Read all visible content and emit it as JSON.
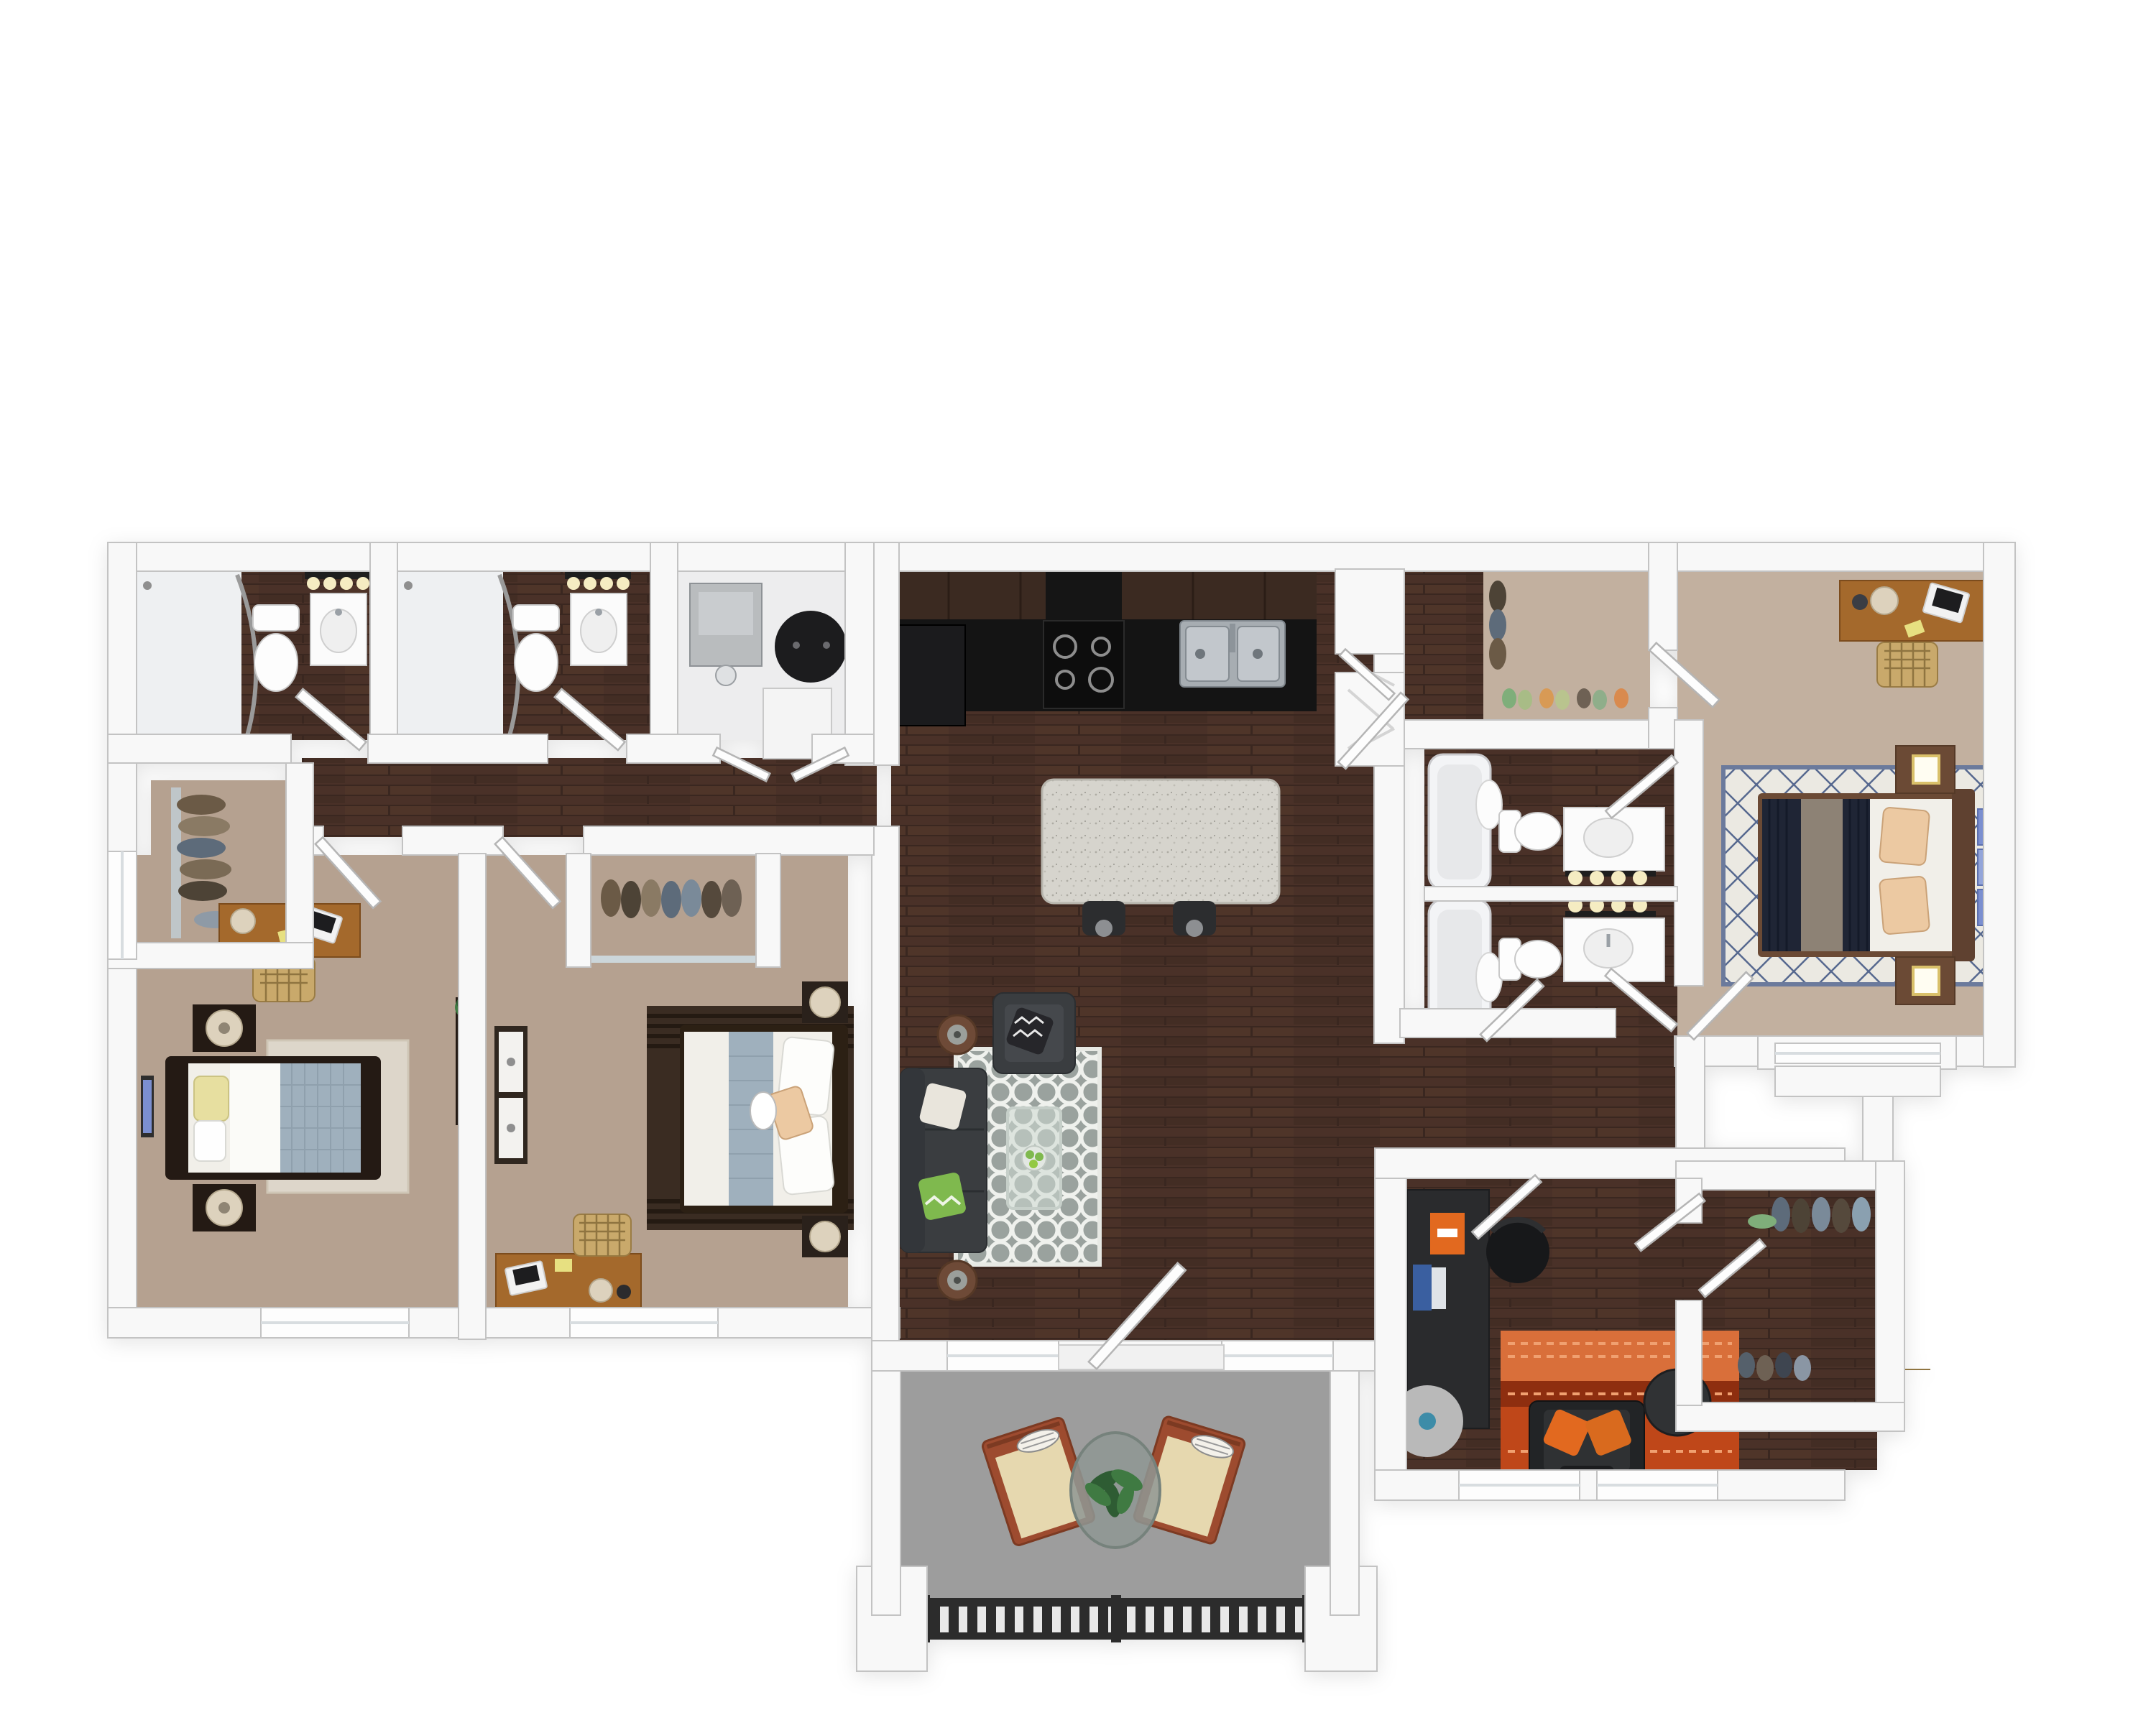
{
  "colors": {
    "wall": "#f8f8f8",
    "wall-stroke": "#c3c3c3",
    "wood": "#4a3128",
    "wood-dark": "#3a2720",
    "wood-light": "#593b2c",
    "carpet": "#b5a190",
    "carpet-light": "#c2b09f",
    "tile": "#eef0f2",
    "white-floor": "#ededee",
    "counter": "#141414",
    "cabinet": "#3b2a21",
    "steel": "#a7adb2",
    "island": "#d6d4cd",
    "stool": "#2c2d2f",
    "sofa": "#3a3d40",
    "pillow-white": "#e9e5dc",
    "pillow-green": "#7fb94e",
    "pillow-bw": "#26262a",
    "rug-gray": "#9aa29e",
    "rug-white": "#eff1ed",
    "glass": "#cdd8d2",
    "desk-wood": "#a4692c",
    "chair-tan": "#c9a96b",
    "bed-white": "#f1efe9",
    "duvet-gray": "#9fb0bd",
    "pillow-yellow": "#e7dfa0",
    "dark-furn": "#241a14",
    "lamp-cream": "#ddd2bd",
    "navy": "#1f2535",
    "throw-gray": "#8d8275",
    "pillow-peach": "#ecc9a2",
    "ns-wood": "#6b4a35",
    "lamp-gold": "#d9c06a",
    "art-blue": "#7b8fd0",
    "rug-diamond-bg": "#ebe9e2",
    "rug-diamond-line": "#56688f",
    "office-desk": "#2a2b2d",
    "accent-orange": "#e2691f",
    "rug-orange": "#bf4719",
    "rug-orange-dark": "#8e2e0f",
    "rug-orange-light": "#d96f3a",
    "patio": "#9d9d9d",
    "railing": "#2c2c2c",
    "chair-frame": "#9d4b2f",
    "cushion": "#e6d8af",
    "plant": "#2e5c33",
    "plant-light": "#3f7a42",
    "bulb": "#f5ecc2",
    "fixture": "#1e1e1e",
    "tub": "#f3f4f6",
    "appliance-gray": "#b9bcbe",
    "heater": "#1c1c1e"
  },
  "plan": {
    "view": "top-down-3d-floor-plan",
    "rooms": [
      {
        "name": "bathroom-1",
        "furniture": [
          "walk-in-shower",
          "curtain-rod",
          "toilet",
          "vanity-sink",
          "vanity-lights",
          "door"
        ]
      },
      {
        "name": "bathroom-2",
        "furniture": [
          "walk-in-shower",
          "curtain-rod",
          "toilet",
          "vanity-sink",
          "vanity-lights",
          "door"
        ]
      },
      {
        "name": "laundry-room",
        "furniture": [
          "washer",
          "water-heater",
          "dryer",
          "bifold-doors"
        ]
      },
      {
        "name": "kitchen",
        "furniture": [
          "upper-cabinets",
          "black-countertop",
          "refrigerator",
          "range",
          "range-hood",
          "double-sink",
          "pantry",
          "corner-shelves",
          "island",
          "bar-stools"
        ]
      },
      {
        "name": "living-room",
        "furniture": [
          "tv",
          "sofa",
          "armchair",
          "quatrefoil-rug",
          "glass-coffee-table",
          "fruit-bowl",
          "round-side-tables",
          "entry-door",
          "windows"
        ]
      },
      {
        "name": "hallway-left",
        "furniture": [
          "doors"
        ]
      },
      {
        "name": "bedroom-1",
        "furniture": [
          "closet",
          "hanging-clothes",
          "desk",
          "laptop",
          "desk-chair",
          "bed",
          "yellow-pillow",
          "gray-duvet",
          "nightstands",
          "lamps",
          "wall-art",
          "dresser",
          "plant",
          "area-rug",
          "windows"
        ]
      },
      {
        "name": "bedroom-2",
        "furniture": [
          "mirror-closet",
          "hanging-clothes",
          "dresser",
          "wall-art",
          "bed",
          "accent-pillow",
          "striped-rug",
          "nightstands",
          "lamps",
          "desk",
          "laptop",
          "desk-chair",
          "window"
        ]
      },
      {
        "name": "master-walk-in-closet",
        "furniture": [
          "hanging-clothes",
          "shoe-row",
          "door"
        ]
      },
      {
        "name": "master-bathroom-1",
        "furniture": [
          "tub",
          "shower-curtain",
          "toilet",
          "vanity-sink",
          "vanity-lights",
          "door"
        ]
      },
      {
        "name": "master-bathroom-2",
        "furniture": [
          "tub",
          "shower-curtain",
          "toilet",
          "vanity-sink",
          "vanity-lights",
          "door"
        ]
      },
      {
        "name": "master-bedroom",
        "furniture": [
          "desk",
          "laptop",
          "desk-chair",
          "bed",
          "navy-duvet",
          "gray-throw",
          "peach-pillows",
          "diamond-rug",
          "nightstands",
          "gold-lamps",
          "wall-art",
          "bay-window",
          "door"
        ]
      },
      {
        "name": "hallway-right",
        "furniture": [
          "doors"
        ]
      },
      {
        "name": "office-den",
        "furniture": [
          "dark-desk",
          "monitor",
          "orange-box",
          "office-chair",
          "round-mat",
          "orange-striped-rug",
          "armchair",
          "orange-pillows",
          "round-side-table",
          "windows",
          "door"
        ]
      },
      {
        "name": "office-walk-in-closet",
        "furniture": [
          "hanging-clothes",
          "shoes",
          "doors"
        ]
      },
      {
        "name": "patio",
        "furniture": [
          "lounge-chair-left",
          "lounge-chair-right",
          "striped-pillows",
          "round-glass-table",
          "potted-plant",
          "railing",
          "storage-louver-door",
          "steps"
        ]
      }
    ]
  }
}
